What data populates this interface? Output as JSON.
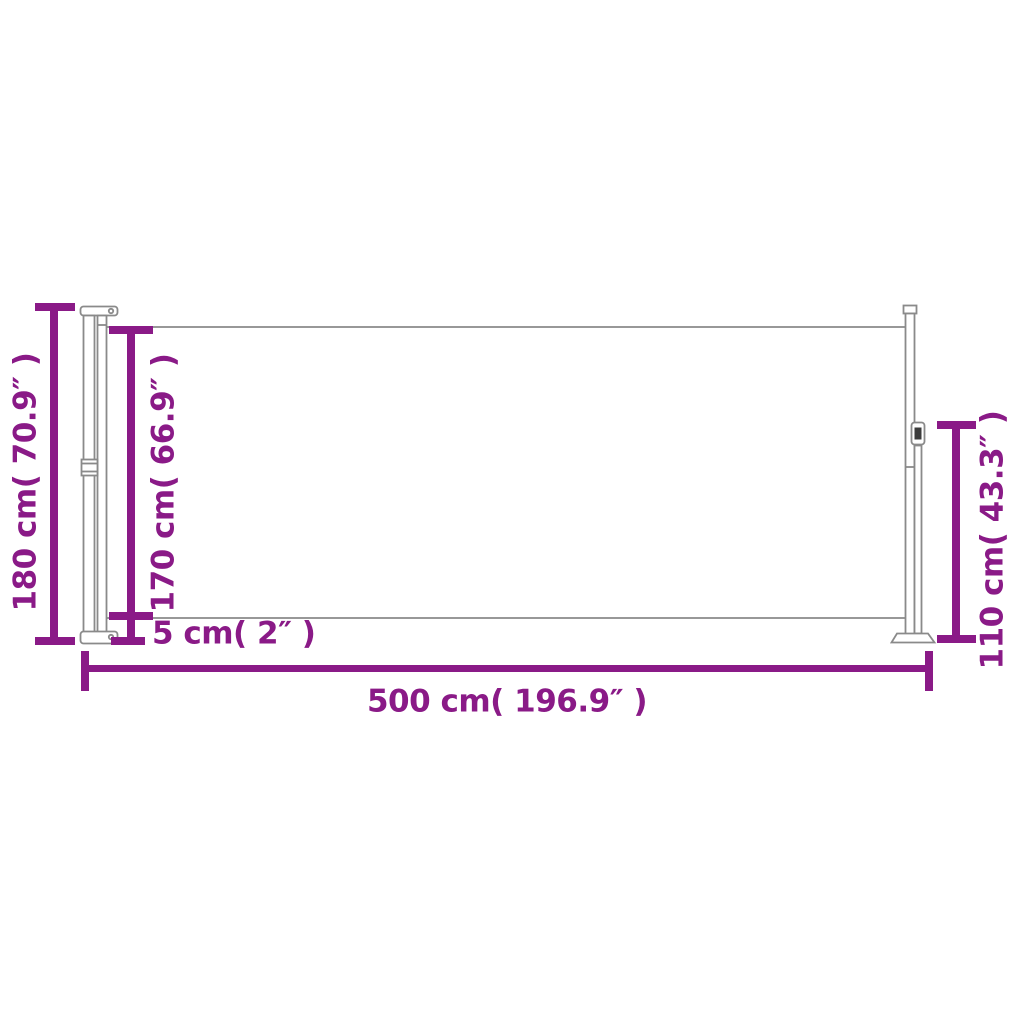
{
  "diagram": {
    "colors": {
      "accent": "#8A1A87",
      "line": "#8A8A8A",
      "dark": "#3C3C3C",
      "background": "#FFFFFF"
    },
    "labels": {
      "overall_height": "180 cm( 70.9″ )",
      "fabric_height": "170 cm( 66.9″ )",
      "bottom_gap": "5 cm( 2″ )",
      "overall_length": "500 cm( 196.9″ )",
      "end_pole_height": "110 cm( 43.3″ )"
    }
  }
}
